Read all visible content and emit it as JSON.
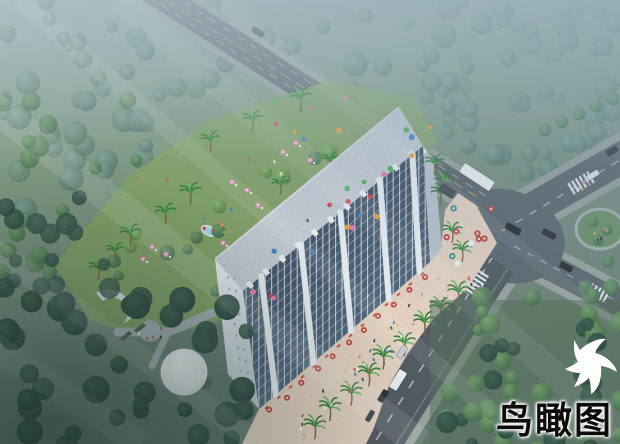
{
  "image": {
    "type": "architectural-aerial-rendering",
    "subject": "Bird's-eye dusk rendering of a long mid-rise building with rooftop, landscaped palm garden with glass dome, front pedestrian plaza with red umbrellas, and a street intersection with vehicles; misty forest surrounds the site; a white bird flies at lower right"
  },
  "caption": {
    "text": "鸟瞰图"
  },
  "icons": {
    "bird": "flying-bird-silhouette"
  },
  "palette": {
    "mist": "#a9bcbd",
    "mist_blue": "#7e99a6",
    "lawn": "#7f9478",
    "forest_dark": "#31524a",
    "forest_mid": "#4c7350",
    "forest_bright": "#6e9a58",
    "garden_lawn": "#83a164",
    "road": "#59626a",
    "road_front": "#4f575e",
    "sidewalk": "#99a29b",
    "plaza": "#e7d3c2",
    "roof": "#c9ced6",
    "eave_white": "#f2f5f8",
    "facade_dark": "#2f3d52",
    "facade_light": "#54687f",
    "pier_white": "#edf1f5",
    "umbrella_red": "#c2473e",
    "umbrella_teal": "#3e948e",
    "umbrella_pink": "#de8fb0",
    "balloon_red": "#e0404a",
    "balloon_blue": "#3f7fd0",
    "balloon_pink": "#e878a8",
    "balloon_orange": "#f0a030",
    "balloon_green": "#50b060",
    "lane_yellow": "#d8c24a",
    "dome_white": "#eef2f4",
    "bird_white": "#ffffff",
    "caption_color": "#0c0c0c",
    "caption_glow": "#ffffff"
  }
}
